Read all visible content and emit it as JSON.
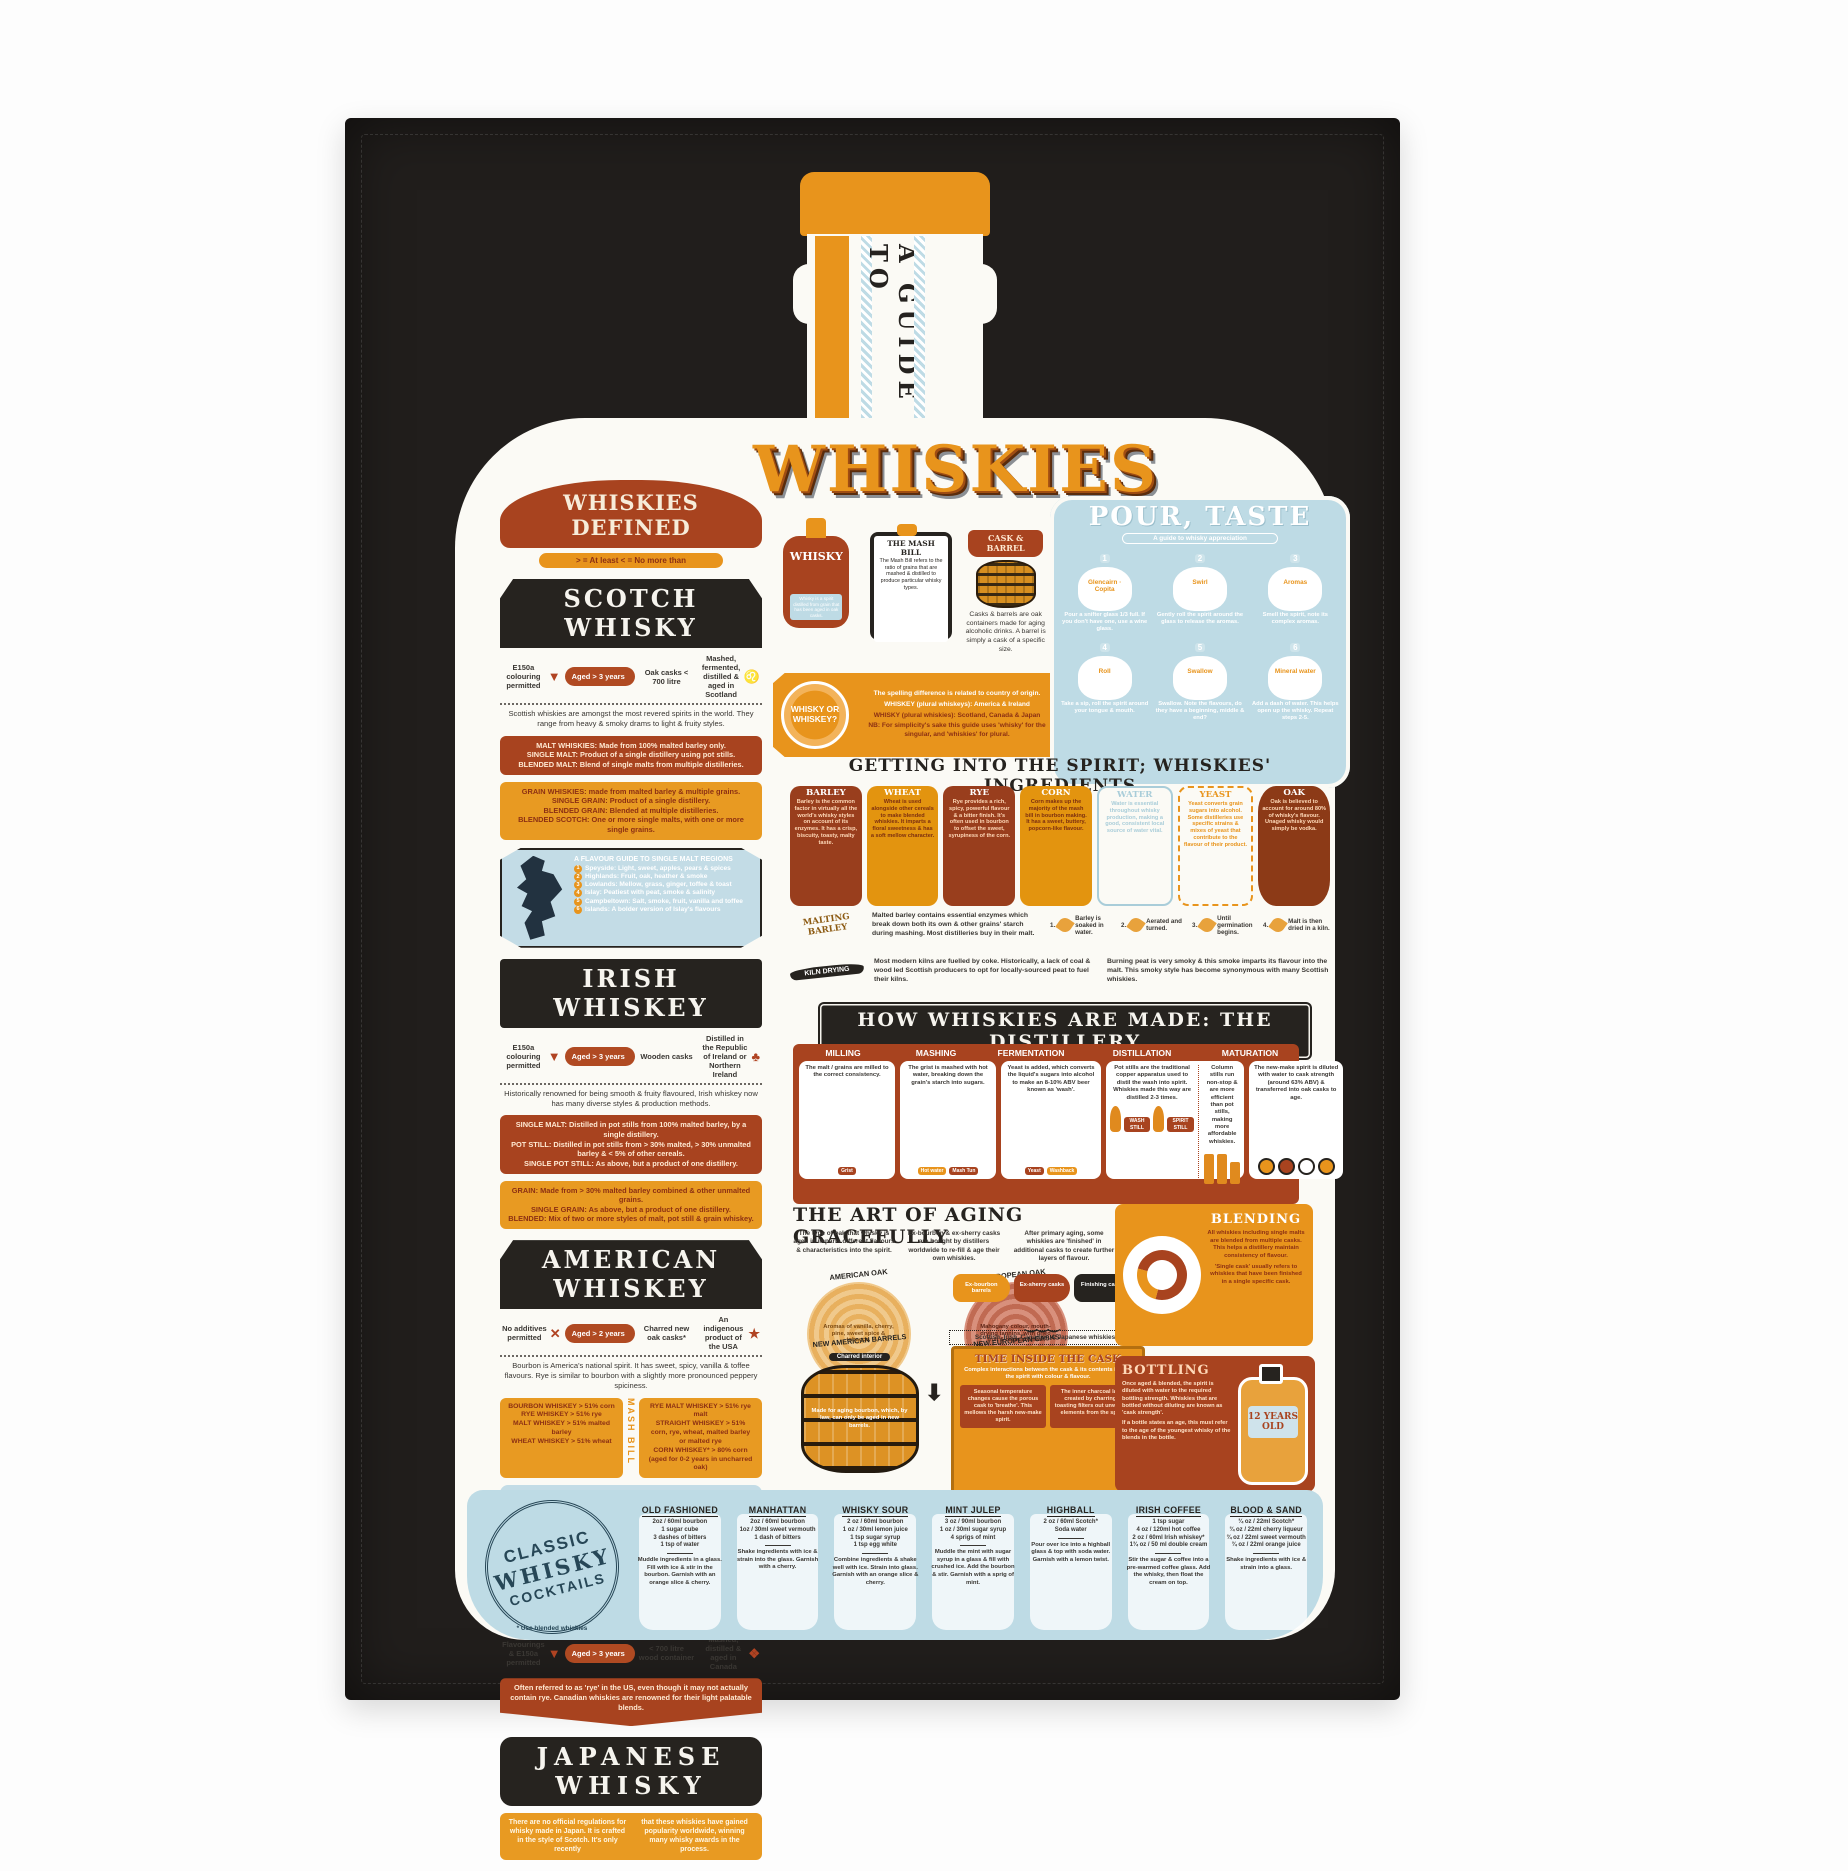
{
  "neck": {
    "vertical_text": "A GUIDE TO"
  },
  "title": "WHISKIES",
  "defined": {
    "banner": "WHISKIES DEFINED",
    "legend": "> = At least   < = No more than"
  },
  "scotch": {
    "title": "SCOTCH WHISKY",
    "facts": [
      {
        "label": "E150a colouring permitted",
        "icon": "dropper-icon",
        "glyph": "▼"
      },
      {
        "label": "Aged > 3 years",
        "icon": "",
        "glyph": ""
      },
      {
        "label": "Oak casks < 700 litre",
        "icon": "cask-icon",
        "glyph": ""
      },
      {
        "label": "Mashed, fermented, distilled & aged in Scotland",
        "icon": "lion-icon",
        "glyph": "♌"
      }
    ],
    "intro": "Scottish whiskies are amongst the most revered spirits in the world. They range from heavy & smoky drams to light & fruity styles.",
    "malt_lines": [
      "MALT WHISKIES: Made from 100% malted barley only.",
      "SINGLE MALT: Product of a single distillery using pot stills.",
      "BLENDED MALT: Blend of single malts from multiple distilleries."
    ],
    "grain_lines": [
      "GRAIN WHISKIES: made from malted barley & multiple grains.",
      "SINGLE GRAIN: Product of a single distillery.",
      "BLENDED GRAIN: Blended at multiple distilleries.",
      "BLENDED SCOTCH: One or more single malts, with one or more single grains."
    ],
    "regions": {
      "title": "A FLAVOUR GUIDE TO SINGLE MALT REGIONS",
      "items": [
        {
          "num": "1",
          "text": "Speyside: Light, sweet, apples, pears & spices"
        },
        {
          "num": "2",
          "text": "Highlands: Fruit, oak, heather & smoke"
        },
        {
          "num": "3",
          "text": "Lowlands: Mellow, grass, ginger, toffee & toast"
        },
        {
          "num": "4",
          "text": "Islay: Peatiest with peat, smoke & salinity"
        },
        {
          "num": "5",
          "text": "Campbeltown: Salt, smoke, fruit, vanilla and toffee"
        },
        {
          "num": "6",
          "text": "Islands: A bolder version of Islay's flavours"
        }
      ]
    }
  },
  "irish": {
    "title": "IRISH WHISKEY",
    "facts": [
      {
        "label": "E150a colouring permitted",
        "icon": "dropper-icon",
        "glyph": "▼"
      },
      {
        "label": "Aged > 3 years",
        "icon": "",
        "glyph": ""
      },
      {
        "label": "Wooden casks",
        "icon": "cask-icon",
        "glyph": ""
      },
      {
        "label": "Distilled in the Republic of Ireland or Northern Ireland",
        "icon": "shamrock-icon",
        "glyph": "♣"
      }
    ],
    "intro": "Historically renowned for being smooth & fruity flavoured, Irish whiskey now has many diverse styles & production methods.",
    "malt_lines": [
      "SINGLE MALT: Distilled in pot stills from 100% malted barley, by a single distillery.",
      "POT STILL: Distilled in pot stills from > 30% malted, > 30% unmalted barley & < 5% of other cereals.",
      "SINGLE POT STILL: As above, but a product of one distillery."
    ],
    "grain_lines": [
      "GRAIN: Made from > 30% malted barley combined & other unmalted grains.",
      "SINGLE GRAIN: As above, but a product of one distillery.",
      "BLENDED: Mix of two or more styles of malt, pot still & grain whiskey."
    ]
  },
  "american": {
    "title": "AMERICAN WHISKEY",
    "facts": [
      {
        "label": "No additives permitted",
        "icon": "crossed-dropper-icon",
        "glyph": "✕"
      },
      {
        "label": "Aged > 2 years",
        "icon": "",
        "glyph": ""
      },
      {
        "label": "Charred new oak casks*",
        "icon": "cask-icon",
        "glyph": ""
      },
      {
        "label": "An indigenous product of the USA",
        "icon": "usa-star-icon",
        "glyph": "★"
      }
    ],
    "intro": "Bourbon is America's national spirit. It has sweet, spicy, vanilla & toffee flavours. Rye is similar to bourbon with a slightly more pronounced peppery spiciness.",
    "mash_bill_label": "MASH BILL",
    "left_lines": [
      "BOURBON WHISKEY > 51% corn",
      "RYE WHISKEY > 51% rye",
      "MALT WHISKEY > 51% malted barley",
      "WHEAT WHISKEY > 51% wheat"
    ],
    "right_lines": [
      "RYE MALT WHISKEY > 51% rye malt",
      "STRAIGHT WHISKEY > 51% corn, rye, wheat, malted barley or malted rye",
      "CORN WHISKEY* > 80% corn (aged for 0-2 years in uncharred oak)"
    ],
    "map_lines": [
      "★ KENTUCKY WHISKEY: Bourbon made in Kentucky.",
      "★ TENNESSEE WHISKEY: Bourbon made in Tennessee & filtered through sugar maple charcoal before aging (known as the Lincoln County Process)."
    ]
  },
  "canadian": {
    "title": "CANADIAN WHISKY",
    "facts": [
      {
        "label": "Flavourings & E150a permitted",
        "icon": "dropper-icon",
        "glyph": "▼"
      },
      {
        "label": "Aged > 3 years",
        "icon": "",
        "glyph": ""
      },
      {
        "label": "< 700 litre wood container",
        "icon": "cask-icon",
        "glyph": ""
      },
      {
        "label": "Mashed, distilled & aged in Canada",
        "icon": "maple-leaf-icon",
        "glyph": "❖"
      }
    ],
    "note": "Often referred to as 'rye' in the US, even though it may not actually contain rye. Canadian whiskies are renowned for their light palatable blends."
  },
  "japanese": {
    "title": "JAPANESE WHISKY",
    "left": "There are no official regulations for whisky made in Japan. It is crafted in the style of Scotch. It's only recently",
    "right": "that these whiskies have gained popularity worldwide, winning many whisky awards in the process."
  },
  "bottle_card": {
    "label": "WHISKY",
    "caption": "Whisky is a spirit distilled from grain that has been aged in oak casks."
  },
  "mash_bill_card": {
    "title": "THE MASH BILL",
    "text": "The Mash Bill refers to the ratio of grains that are mashed & distilled to produce particular whisky types."
  },
  "cask_card": {
    "title": "CASK & BARREL",
    "text": "Casks & barrels are oak containers made for aging alcoholic drinks. A barrel is simply a cask of a specific size."
  },
  "wow": {
    "badge": "WHISKY OR WHISKEY?",
    "lines": [
      "The spelling difference is related to country of origin.",
      "WHISKEY (plural whiskeys): America & Ireland",
      "WHISKY (plural whiskies): Scotland, Canada & Japan",
      "NB: For simplicity's sake this guide uses 'whisky' for the singular, and 'whiskies' for plural."
    ]
  },
  "pour": {
    "title": "POUR, TASTE",
    "subtitle": "A guide to whisky appreciation",
    "steps": [
      {
        "num": "1",
        "label": "Glencairn · Copita",
        "caption": "Pour a snifter glass 1/3 full. If you don't have one, use a wine glass."
      },
      {
        "num": "2",
        "label": "Swirl",
        "caption": "Gently roll the spirit around the glass to release the aromas."
      },
      {
        "num": "3",
        "label": "Aromas",
        "caption": "Smell the spirit, note its complex aromas."
      },
      {
        "num": "4",
        "label": "Roll",
        "caption": "Take a sip, roll the spirit around your tongue & mouth."
      },
      {
        "num": "5",
        "label": "Swallow",
        "caption": "Swallow. Note the flavours, do they have a beginning, middle & end?"
      },
      {
        "num": "6",
        "label": "Mineral water",
        "caption": "Add a dash of water. This helps open up the whisky. Repeat steps 2-5."
      }
    ]
  },
  "ingredients": {
    "headline": "GETTING INTO THE SPIRIT; WHISKIES' INGREDIENTS",
    "items": [
      {
        "name": "BARLEY",
        "style": "dark",
        "text": "Barley is the common factor in virtually all the world's whisky styles on account of its enzymes. It has a crisp, biscuity, toasty, malty taste."
      },
      {
        "name": "WHEAT",
        "style": "orange",
        "text": "Wheat is used alongside other cereals to make blended whiskies. It imparts a floral sweetness & has a soft mellow character."
      },
      {
        "name": "RYE",
        "style": "dark",
        "text": "Rye provides a rich, spicy, powerful flavour & a bitter finish. It's often used in bourbon to offset the sweet, syrupiness of the corn."
      },
      {
        "name": "CORN",
        "style": "orange",
        "text": "Corn makes up the majority of the mash bill in bourbon making. It has a sweet, buttery, popcorn-like flavour."
      },
      {
        "name": "WATER",
        "style": "water",
        "text": "Water is essential throughout whisky production, making a good, consistent local source of water vital."
      },
      {
        "name": "YEAST",
        "style": "yeast",
        "text": "Yeast converts grain sugars into alcohol. Some distilleries use specific strains & mixes of yeast that contribute to the flavour of their product."
      },
      {
        "name": "OAK",
        "style": "oak",
        "text": "Oak is believed to account for around 80% of whisky's flavour. Unaged whisky would simply be vodka."
      }
    ]
  },
  "malting": {
    "badge": "MALTING BARLEY",
    "text": "Malted barley contains essential enzymes which break down both its own & other grains' starch during mashing. Most distilleries buy in their malt.",
    "steps": [
      {
        "num": "1.",
        "text": "Barley is soaked in water."
      },
      {
        "num": "2.",
        "text": "Aerated and turned."
      },
      {
        "num": "3.",
        "text": "Until germination begins."
      },
      {
        "num": "4.",
        "text": "Malt is then dried in a kiln."
      }
    ]
  },
  "kiln": {
    "badge": "KILN DRYING",
    "left": "Most modern kilns are fuelled by coke. Historically, a lack of coal & wood led Scottish producers to opt for locally-sourced peat to fuel their kilns.",
    "right": "Burning peat is very smoky & this smoke imparts its flavour into the malt. This smoky style has become synonymous with many Scottish whiskies."
  },
  "distillery": {
    "banner": "HOW WHISKIES ARE MADE: THE DISTILLERY",
    "titles": [
      "MILLING",
      "MASHING",
      "FERMENTATION",
      "DISTILLATION",
      "MATURATION"
    ],
    "milling": {
      "text": "The malt / grains are milled to the correct consistency.",
      "tag": "Grist"
    },
    "mashing": {
      "text": "The grist is mashed with hot water, breaking down the grain's starch into sugars.",
      "tag1": "Hot water",
      "tag2": "Mash Tun"
    },
    "fermentation": {
      "text": "Yeast is added, which converts the liquid's sugars into alcohol to make an 8-10% ABV beer known as 'wash'.",
      "tag1": "Yeast",
      "tag2": "Washback"
    },
    "distillation_left": {
      "text": "Pot stills are the traditional copper apparatus used to distil the wash into spirit. Whiskies made this way are distilled 2-3 times.",
      "tag1": "WASH STILL",
      "tag2": "SPIRIT STILL"
    },
    "distillation_right": {
      "text": "Column stills run non-stop & are more efficient than pot stills, making more affordable whiskies."
    },
    "maturation": {
      "text": "The new-make spirit is diluted with water to cask strength (around 63% ABV) & transferred into oak casks to age."
    }
  },
  "aging": {
    "headline": "THE ART OF AGING GRACEFULLY",
    "col1": "The type of oak that whisky is aged in imparts different flavours & characteristics into the spirit.",
    "col2": "Ex-bourbon & ex-sherry casks are bought by distillers worldwide to re-fill & age their own whiskies.",
    "col3": "After primary aging, some whiskies are 'finished' in additional casks to create further layers of flavour.",
    "american_oak": {
      "title": "AMERICAN OAK",
      "text": "Aromas of vanilla, cherry, pine, sweet spice & tobacco."
    },
    "european_oak": {
      "title": "EUROPEAN OAK",
      "text": "Mahogany colour, mouth-drying tannins, with dried fruit & resin aromas."
    },
    "pills": [
      {
        "label": "Ex-bourbon barrels",
        "style": "orange"
      },
      {
        "label": "Ex-sherry casks",
        "style": "rust"
      },
      {
        "label": "Finishing casks",
        "style": "black"
      }
    ],
    "note": "Scottish, Irish, Canadian & Japanese whiskies",
    "barrels": [
      {
        "title": "NEW AMERICAN BARRELS",
        "sub": "Charred interior",
        "style": "orange",
        "text": "Made for aging bourbon, which, by law, can only be aged in new barrels."
      },
      {
        "title": "NEW EUROPEAN CASKS",
        "sub": "Toasted interior",
        "style": "rust",
        "text": "Made for aging sherry, port, Madeira & other fine wines."
      }
    ],
    "time_cask": {
      "title": "TIME INSIDE THE CASK",
      "caption": "Complex interactions between the cask & its contents impart the spirit with colour & flavour.",
      "left": "Seasonal temperature changes cause the porous cask to 'breathe'. This mellows the harsh new-make spirit.",
      "right": "The inner charcoal layer created by charring & toasting filters out unwanted elements from the spirit."
    }
  },
  "blending": {
    "title": "BLENDING",
    "p1": "All whiskies including single malts are blended from multiple casks. This helps a distillery maintain consistency of flavour.",
    "p2": "'Single cask' usually refers to whiskies that have been finished in a single specific cask."
  },
  "bottling": {
    "title": "BOTTLING",
    "p1": "Once aged & blended, the spirit is diluted with water to the required bottling strength. Whiskies that are bottled without diluting are known as 'cask strength'.",
    "p2": "If a bottle states an age, this must refer to the age of the youngest whisky of the blends in the bottle.",
    "badge": "12 YEARS OLD"
  },
  "cocktails": {
    "stamp": {
      "line1": "CLASSIC",
      "line2": "WHISKY",
      "line3": "COCKTAILS"
    },
    "note": "* Use blended whiskies",
    "items": [
      {
        "name": "OLD FASHIONED",
        "ingredients": [
          "2oz / 60ml bourbon",
          "1 sugar cube",
          "3 dashes of bitters",
          "1 tsp of water"
        ],
        "method": "Muddle ingredients in a glass. Fill with ice & stir in the bourbon. Garnish with an orange slice & cherry."
      },
      {
        "name": "MANHATTAN",
        "ingredients": [
          "2oz / 60ml bourbon",
          "1oz / 30ml sweet vermouth",
          "1 dash of bitters"
        ],
        "method": "Shake ingredients with ice & strain into the glass. Garnish with a cherry."
      },
      {
        "name": "WHISKY SOUR",
        "ingredients": [
          "2 oz / 60ml bourbon",
          "1 oz / 30ml lemon juice",
          "1 tsp sugar syrup",
          "1 tsp egg white"
        ],
        "method": "Combine ingredients & shake well with ice. Strain into glass. Garnish with an orange slice & cherry."
      },
      {
        "name": "MINT JULEP",
        "ingredients": [
          "3 oz / 90ml bourbon",
          "1 oz / 30ml sugar syrup",
          "4 sprigs of mint"
        ],
        "method": "Muddle the mint with sugar syrup in a glass & fill with crushed ice. Add the bourbon & stir. Garnish with a sprig of mint."
      },
      {
        "name": "HIGHBALL",
        "ingredients": [
          "2 oz / 60ml Scotch*",
          "Soda water"
        ],
        "method": "Pour over ice into a highball glass & top with soda water. Garnish with a lemon twist."
      },
      {
        "name": "IRISH COFFEE",
        "ingredients": [
          "1 tsp sugar",
          "4 oz / 120ml hot coffee",
          "2 oz / 60ml Irish whiskey*",
          "1¾ oz / 50 ml double cream"
        ],
        "method": "Stir the sugar & coffee into a pre-warmed coffee glass. Add the whisky, then float the cream on top."
      },
      {
        "name": "BLOOD & SAND",
        "ingredients": [
          "¾ oz / 22ml Scotch*",
          "¾ oz / 22ml cherry liqueur",
          "¾ oz / 22ml sweet vermouth",
          "¾ oz / 22ml orange juice"
        ],
        "method": "Shake ingredients with ice & strain into a glass."
      }
    ]
  }
}
